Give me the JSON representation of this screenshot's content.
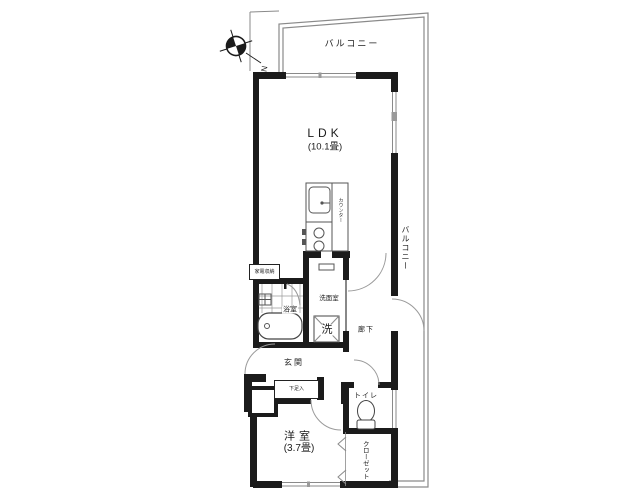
{
  "floor_plan": {
    "labels": {
      "balcony_top": "バルコニー",
      "balcony_right": "バルコニー",
      "ldk_name": "LDK",
      "ldk_size": "(10.1畳)",
      "counter": "カウンター",
      "appliance_storage": "家電収納",
      "bathroom": "浴室",
      "washroom": "洗面室",
      "washing_machine": "洗",
      "hallway": "廊下",
      "entrance": "玄関",
      "shoe_cabinet": "下足入",
      "toilet": "トイレ",
      "western_room_name": "洋室",
      "western_room_size": "(3.7畳)",
      "closet": "クローゼット"
    },
    "compass": {
      "north_label": "N"
    },
    "colors": {
      "wall": "#1b1b1b",
      "thin_line": "#8a8a8a",
      "fixture_line": "#555555",
      "background": "#ffffff"
    }
  }
}
